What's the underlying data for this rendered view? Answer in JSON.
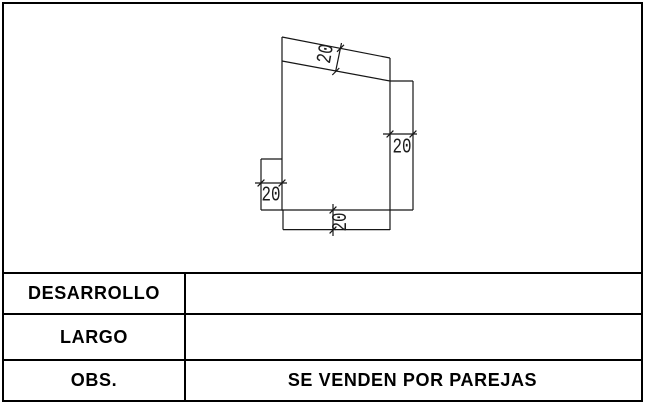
{
  "drawing": {
    "dimensions": {
      "top_flange_width": "20",
      "right_flange_width": "20",
      "bottom_flange_height": "20",
      "left_tab_width": "20"
    }
  },
  "table": {
    "rows": [
      {
        "label": "DESARROLLO",
        "value": ""
      },
      {
        "label": "LARGO",
        "value": ""
      },
      {
        "label": "OBS.",
        "value": "SE VENDEN POR PAREJAS"
      }
    ]
  }
}
